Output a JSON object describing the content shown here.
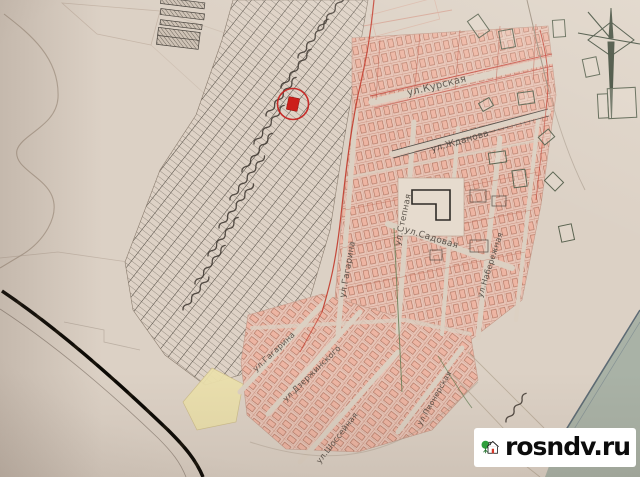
{
  "watermark": {
    "label": "rosndv.ru"
  },
  "map": {
    "marker": {
      "x": 293,
      "y": 104,
      "ring_radius": 15.5,
      "color": "#c5201d"
    },
    "street_labels": [
      {
        "id": "kurskaya",
        "text": "ул.Курская",
        "x": 408,
        "y": 96,
        "rot": -14,
        "size": 10
      },
      {
        "id": "zhdanova",
        "text": "ул.Жданова",
        "x": 432,
        "y": 152,
        "rot": -16,
        "size": 9
      },
      {
        "id": "gagarina-mid",
        "text": "ул.Гагарина",
        "x": 345,
        "y": 298,
        "rot": -80,
        "size": 8.5
      },
      {
        "id": "stepnaya",
        "text": "ул.Степная",
        "x": 400,
        "y": 246,
        "rot": -78,
        "size": 8.5
      },
      {
        "id": "sadovaya",
        "text": "ул.Садовая",
        "x": 404,
        "y": 232,
        "rot": 17,
        "size": 9
      },
      {
        "id": "naberezhnaya",
        "text": "ул.Набережная",
        "x": 482,
        "y": 298,
        "rot": -72,
        "size": 8
      },
      {
        "id": "gagarina-low",
        "text": "ул.Гагарина",
        "x": 256,
        "y": 372,
        "rot": -43,
        "size": 8
      },
      {
        "id": "dzerzhinskogo",
        "text": "ул.Дзержинского",
        "x": 286,
        "y": 402,
        "rot": -44,
        "size": 8
      },
      {
        "id": "shosseynaya",
        "text": "ул.Шоссейная",
        "x": 320,
        "y": 464,
        "rot": -52,
        "size": 8
      },
      {
        "id": "pionerskaya",
        "text": "ул.Пионерская",
        "x": 421,
        "y": 426,
        "rot": -60,
        "size": 7.5
      }
    ],
    "palette": {
      "paper": "#dcd1c5",
      "pink_block": "#e8c4b6",
      "pink_edge": "#b06a58",
      "grid_line": "#4a443c",
      "red_boundary": "#c2392a",
      "railroad": "#171209",
      "water": "#a9b2a6",
      "water_edge": "#5d6b74",
      "marker_red": "#c5201d",
      "building_outline": "#5a6350",
      "watermark_bg": "#ffffff",
      "watermark_text": "#0c0c0c",
      "logo_tree_green": "#2f9e3c",
      "logo_door_red": "#d5382b"
    }
  }
}
